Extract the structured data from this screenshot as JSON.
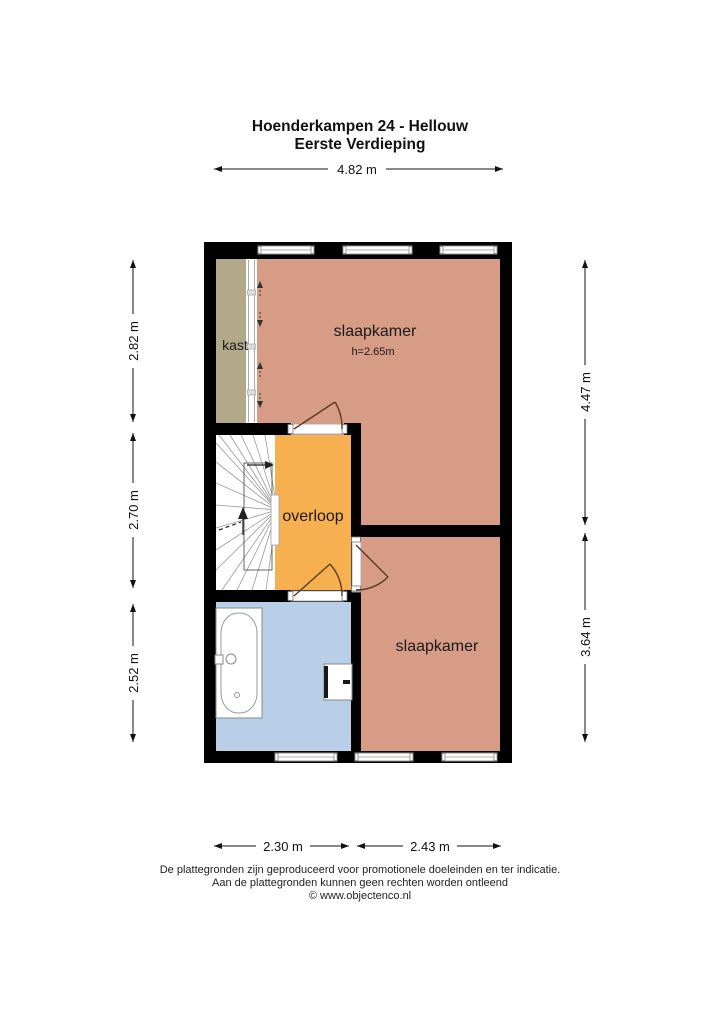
{
  "title": {
    "line1": "Hoenderkampen 24 - Hellouw",
    "line2": "Eerste Verdieping"
  },
  "dimensions": {
    "top": "4.82 m",
    "left": [
      "2.82 m",
      "2.70 m",
      "2.52 m"
    ],
    "right": [
      "4.47 m",
      "3.64 m"
    ],
    "bottom": [
      "2.30 m",
      "2.43 m"
    ]
  },
  "rooms": {
    "closet": {
      "label": "kast"
    },
    "bedroom_top": {
      "label": "slaapkamer",
      "ceiling_height": "h=2.65m"
    },
    "landing": {
      "label": "overloop"
    },
    "bedroom_bottom": {
      "label": "slaapkamer"
    }
  },
  "footer": {
    "line1": "De plattegronden zijn geproduceerd voor promotionele doeleinden en ter indicatie.",
    "line2": "Aan de plattegronden kunnen geen rechten worden ontleend",
    "line3": "© www.objectenco.nl"
  },
  "colors": {
    "wall": "#000000",
    "bedroom": "#d69c86",
    "closet": "#b2a98a",
    "landing": "#f6b04f",
    "bathroom": "#b9cfe8",
    "door": "#5c3a24"
  }
}
